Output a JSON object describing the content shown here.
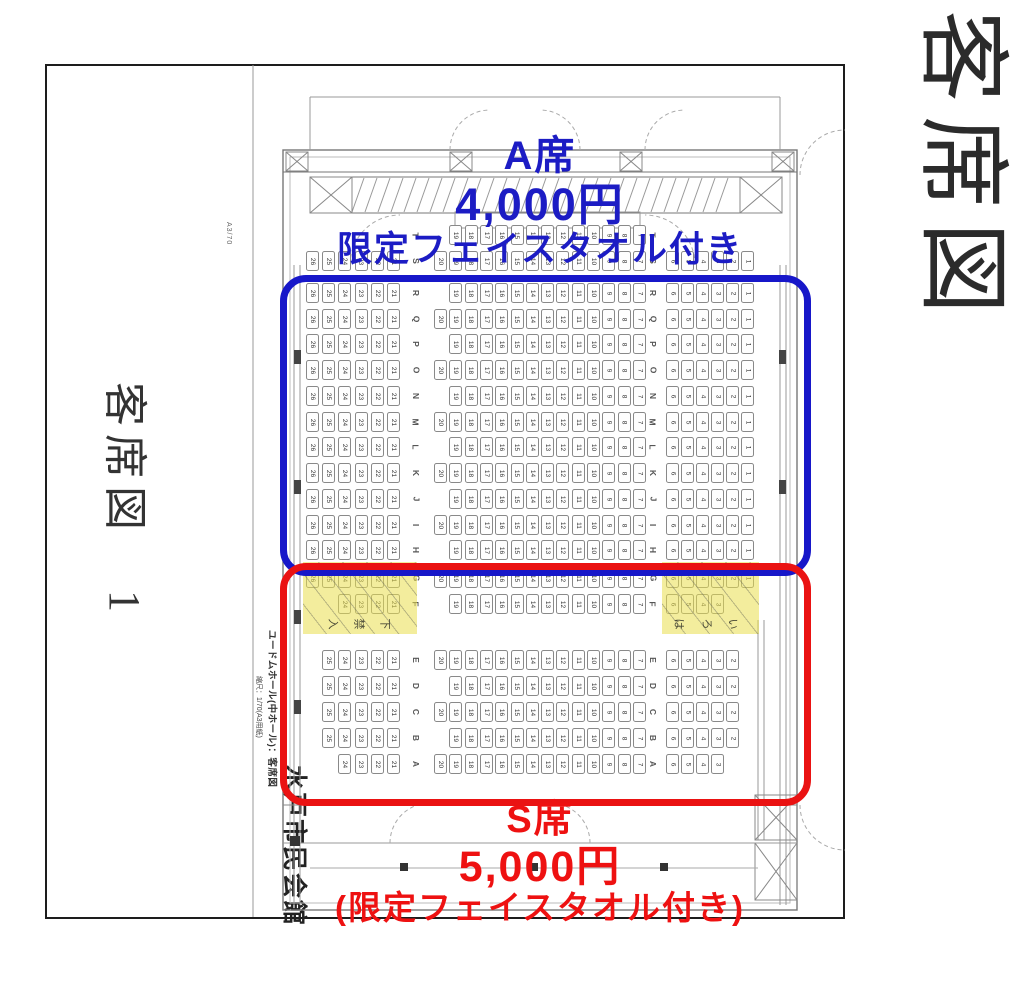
{
  "right_title": "客席図",
  "left_margin": {
    "title": "客席図　1",
    "paper_note": "A3/70"
  },
  "annotations": {
    "a": {
      "name": "A席",
      "price": "4,000円",
      "note": "限定フェイスタオル付き",
      "color": "#1c1cc4"
    },
    "s": {
      "name": "S席",
      "price": "5,000円",
      "note": "(限定フェイスタオル付き)",
      "color": "#ee1111"
    }
  },
  "plan": {
    "venue": "水戸市民会館",
    "hall_label": "ユードムホール(中ホール)：客席図",
    "scale_label": "縮尺：1/70(A3用紙)",
    "fine_print": "図面と実際とは多少異なる場合があります",
    "aisle_marks_left": [
      "入",
      "禁",
      "下"
    ],
    "aisle_marks_right": [
      "は",
      "ろ",
      "い"
    ],
    "rows": [
      {
        "letter": "T",
        "y": 225,
        "left": [],
        "center": [
          19,
          18,
          17,
          16,
          15,
          14,
          13,
          12,
          11,
          10,
          9,
          8,
          7
        ],
        "right": [],
        "hl": false
      },
      {
        "letter": "S",
        "y": 251,
        "left": [
          26,
          25,
          24,
          23,
          22,
          21
        ],
        "center": [
          20,
          19,
          18,
          17,
          16,
          15,
          14,
          13,
          12,
          11,
          10,
          9,
          8,
          7
        ],
        "right": [
          6,
          5,
          4,
          3,
          2,
          1
        ],
        "hl": false
      },
      {
        "letter": "R",
        "y": 283,
        "left": [
          26,
          25,
          24,
          23,
          22,
          21
        ],
        "center": [
          19,
          18,
          17,
          16,
          15,
          14,
          13,
          12,
          11,
          10,
          9,
          8,
          7
        ],
        "right": [
          6,
          5,
          4,
          3,
          2,
          1
        ],
        "hl": false
      },
      {
        "letter": "Q",
        "y": 309,
        "left": [
          26,
          25,
          24,
          23,
          22,
          21
        ],
        "center": [
          20,
          19,
          18,
          17,
          16,
          15,
          14,
          13,
          12,
          11,
          10,
          9,
          8,
          7
        ],
        "right": [
          6,
          5,
          4,
          3,
          2,
          1
        ],
        "hl": false
      },
      {
        "letter": "P",
        "y": 334,
        "left": [
          26,
          25,
          24,
          23,
          22,
          21
        ],
        "center": [
          19,
          18,
          17,
          16,
          15,
          14,
          13,
          12,
          11,
          10,
          9,
          8,
          7
        ],
        "right": [
          6,
          5,
          4,
          3,
          2,
          1
        ],
        "hl": false
      },
      {
        "letter": "O",
        "y": 360,
        "left": [
          26,
          25,
          24,
          23,
          22,
          21
        ],
        "center": [
          20,
          19,
          18,
          17,
          16,
          15,
          14,
          13,
          12,
          11,
          10,
          9,
          8,
          7
        ],
        "right": [
          6,
          5,
          4,
          3,
          2,
          1
        ],
        "hl": false
      },
      {
        "letter": "N",
        "y": 386,
        "left": [
          26,
          25,
          24,
          23,
          22,
          21
        ],
        "center": [
          19,
          18,
          17,
          16,
          15,
          14,
          13,
          12,
          11,
          10,
          9,
          8,
          7
        ],
        "right": [
          6,
          5,
          4,
          3,
          2,
          1
        ],
        "hl": false
      },
      {
        "letter": "M",
        "y": 412,
        "left": [
          26,
          25,
          24,
          23,
          22,
          21
        ],
        "center": [
          20,
          19,
          18,
          17,
          16,
          15,
          14,
          13,
          12,
          11,
          10,
          9,
          8,
          7
        ],
        "right": [
          6,
          5,
          4,
          3,
          2,
          1
        ],
        "hl": false
      },
      {
        "letter": "L",
        "y": 437,
        "left": [
          26,
          25,
          24,
          23,
          22,
          21
        ],
        "center": [
          19,
          18,
          17,
          16,
          15,
          14,
          13,
          12,
          11,
          10,
          9,
          8,
          7
        ],
        "right": [
          6,
          5,
          4,
          3,
          2,
          1
        ],
        "hl": false
      },
      {
        "letter": "K",
        "y": 463,
        "left": [
          26,
          25,
          24,
          23,
          22,
          21
        ],
        "center": [
          20,
          19,
          18,
          17,
          16,
          15,
          14,
          13,
          12,
          11,
          10,
          9,
          8,
          7
        ],
        "right": [
          6,
          5,
          4,
          3,
          2,
          1
        ],
        "hl": false
      },
      {
        "letter": "J",
        "y": 489,
        "left": [
          26,
          25,
          24,
          23,
          22,
          21
        ],
        "center": [
          19,
          18,
          17,
          16,
          15,
          14,
          13,
          12,
          11,
          10,
          9,
          8,
          7
        ],
        "right": [
          6,
          5,
          4,
          3,
          2,
          1
        ],
        "hl": false
      },
      {
        "letter": "I",
        "y": 515,
        "left": [
          26,
          25,
          24,
          23,
          22,
          21
        ],
        "center": [
          20,
          19,
          18,
          17,
          16,
          15,
          14,
          13,
          12,
          11,
          10,
          9,
          8,
          7
        ],
        "right": [
          6,
          5,
          4,
          3,
          2,
          1
        ],
        "hl": false
      },
      {
        "letter": "H",
        "y": 540,
        "left": [
          26,
          25,
          24,
          23,
          22,
          21
        ],
        "center": [
          19,
          18,
          17,
          16,
          15,
          14,
          13,
          12,
          11,
          10,
          9,
          8,
          7
        ],
        "right": [
          6,
          5,
          4,
          3,
          2,
          1
        ],
        "hl": false
      },
      {
        "letter": "G",
        "y": 568,
        "left": [
          26,
          25,
          24,
          23,
          22,
          21
        ],
        "center": [
          20,
          19,
          18,
          17,
          16,
          15,
          14,
          13,
          12,
          11,
          10,
          9,
          8,
          7
        ],
        "right": [
          6,
          5,
          4,
          3,
          2,
          1
        ],
        "hl": true
      },
      {
        "letter": "F",
        "y": 594,
        "left": [
          24,
          23,
          22,
          21
        ],
        "center": [
          19,
          18,
          17,
          16,
          15,
          14,
          13,
          12,
          11,
          10,
          9,
          8,
          7
        ],
        "right": [
          6,
          5,
          4,
          3
        ],
        "hl": true
      },
      {
        "letter": "E",
        "y": 650,
        "left": [
          25,
          24,
          23,
          22,
          21
        ],
        "center": [
          20,
          19,
          18,
          17,
          16,
          15,
          14,
          13,
          12,
          11,
          10,
          9,
          8,
          7
        ],
        "right": [
          6,
          5,
          4,
          3,
          2
        ],
        "hl": false
      },
      {
        "letter": "D",
        "y": 676,
        "left": [
          25,
          24,
          23,
          22,
          21
        ],
        "center": [
          19,
          18,
          17,
          16,
          15,
          14,
          13,
          12,
          11,
          10,
          9,
          8,
          7
        ],
        "right": [
          6,
          5,
          4,
          3,
          2
        ],
        "hl": false
      },
      {
        "letter": "C",
        "y": 702,
        "left": [
          25,
          24,
          23,
          22,
          21
        ],
        "center": [
          20,
          19,
          18,
          17,
          16,
          15,
          14,
          13,
          12,
          11,
          10,
          9,
          8,
          7
        ],
        "right": [
          6,
          5,
          4,
          3,
          2
        ],
        "hl": false
      },
      {
        "letter": "B",
        "y": 728,
        "left": [
          25,
          24,
          23,
          22,
          21
        ],
        "center": [
          19,
          18,
          17,
          16,
          15,
          14,
          13,
          12,
          11,
          10,
          9,
          8,
          7
        ],
        "right": [
          6,
          5,
          4,
          3,
          2
        ],
        "hl": false
      },
      {
        "letter": "A",
        "y": 754,
        "left": [
          24,
          23,
          22,
          21
        ],
        "center": [
          20,
          19,
          18,
          17,
          16,
          15,
          14,
          13,
          12,
          11,
          10,
          9,
          8,
          7
        ],
        "right": [
          6,
          5,
          4,
          3
        ],
        "hl": false
      }
    ]
  }
}
